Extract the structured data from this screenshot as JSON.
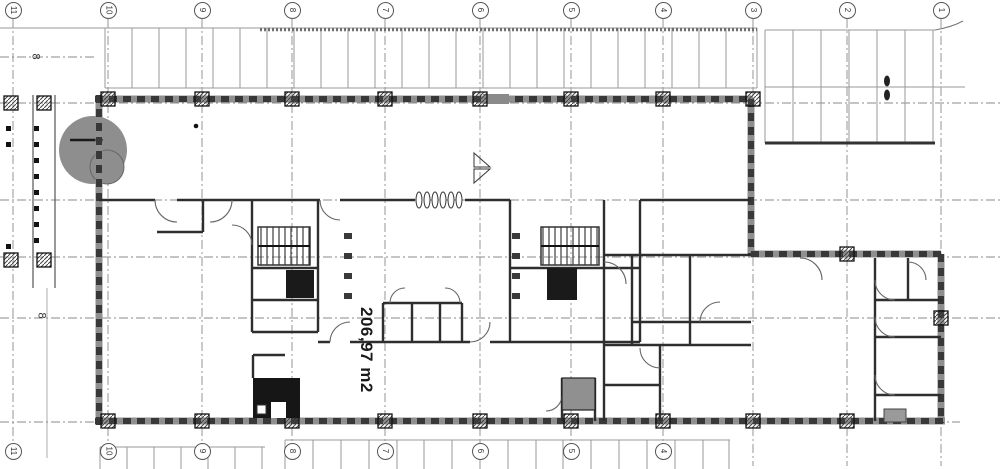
{
  "drawing": {
    "type": "architectural-floor-plan",
    "area_label": "206,97 m2",
    "grid": {
      "top_labels": [
        "11",
        "10",
        "9",
        "8",
        "7",
        "6",
        "5",
        "4",
        "3",
        "2",
        "1"
      ],
      "bottom_labels": [
        "11",
        "10",
        "9",
        "8",
        "7",
        "6",
        "5",
        "4"
      ],
      "left_row_markers": [
        "8",
        "8"
      ]
    },
    "colors": {
      "background": "#ffffff",
      "wall_dark": "#383838",
      "wall_core": "#8f8f8f",
      "grid_line": "#8a8a8a",
      "gray_fill": "#8e8e8e",
      "black_fill": "#161616"
    }
  }
}
